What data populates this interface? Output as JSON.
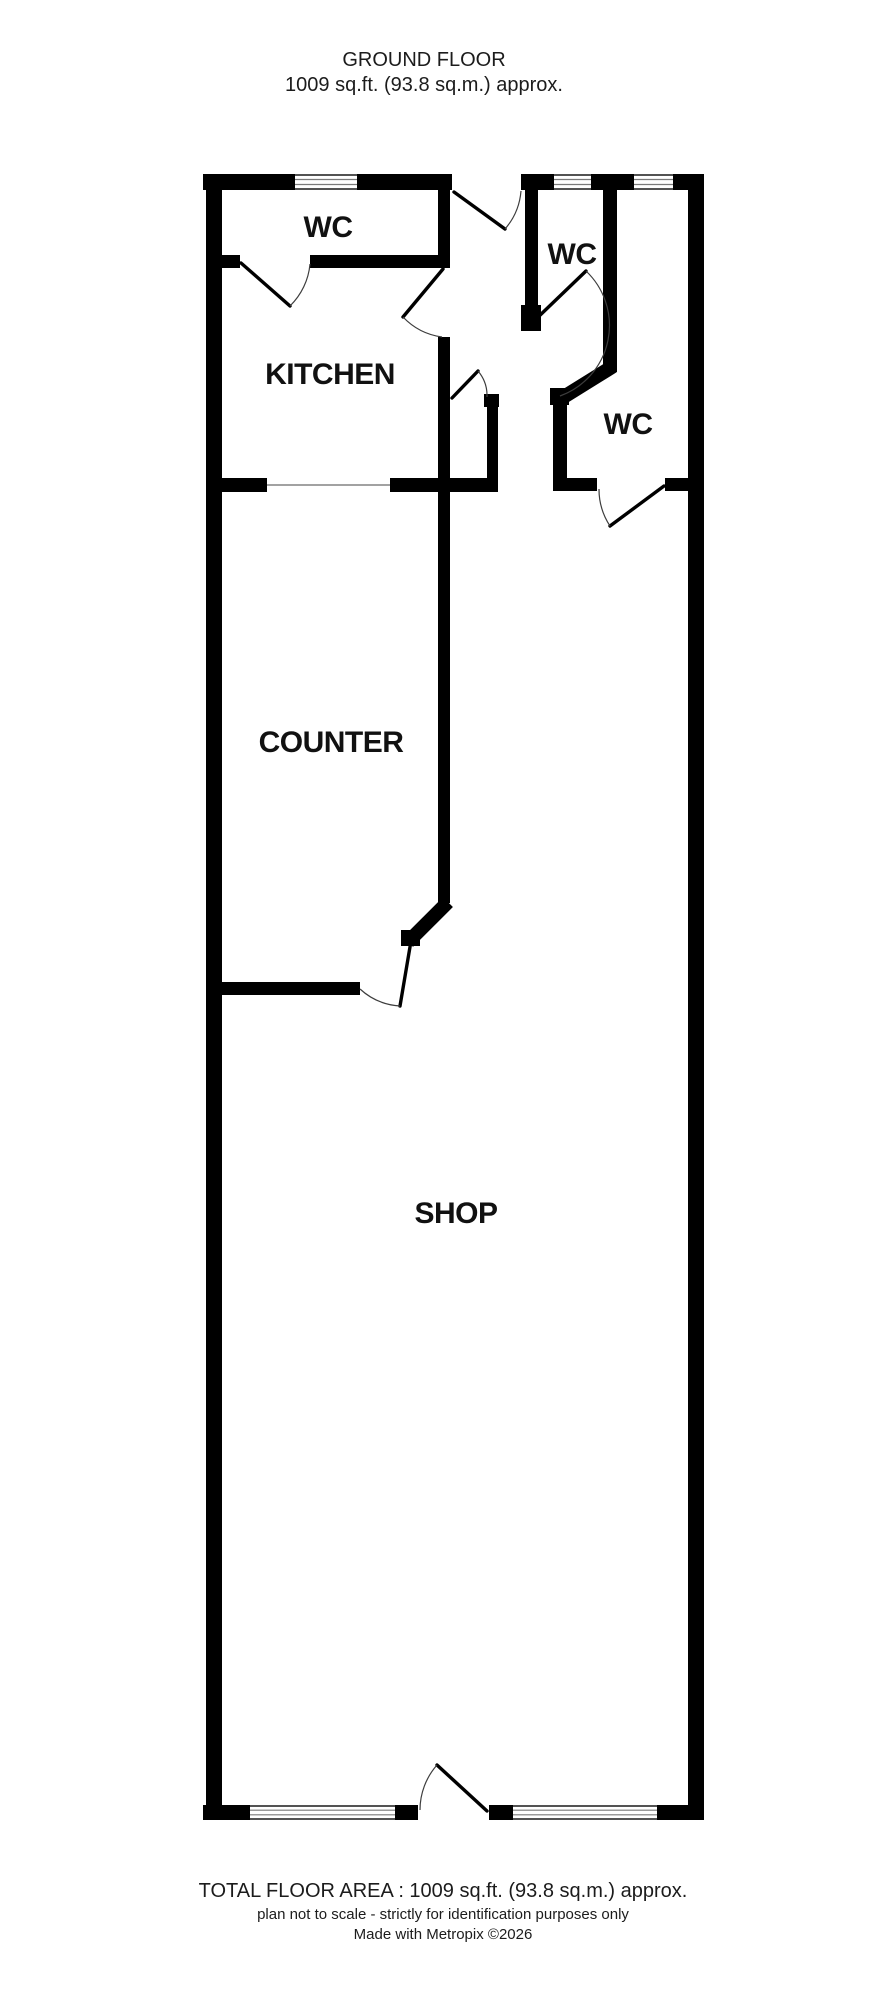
{
  "title": {
    "line1": "GROUND FLOOR",
    "line2": "1009 sq.ft. (93.8 sq.m.) approx."
  },
  "rooms": [
    {
      "id": "wc-top-left",
      "label": "WC"
    },
    {
      "id": "kitchen",
      "label": "KITCHEN"
    },
    {
      "id": "wc-middle",
      "label": "WC"
    },
    {
      "id": "wc-right",
      "label": "WC"
    },
    {
      "id": "counter",
      "label": "COUNTER"
    },
    {
      "id": "shop",
      "label": "SHOP"
    }
  ],
  "footer": {
    "total_area": "TOTAL FLOOR AREA : 1009 sq.ft. (93.8 sq.m.) approx.",
    "disclaimer": "plan not to scale - strictly for identification purposes only",
    "credit": "Made with Metropix ©2026"
  },
  "colors": {
    "wall": "#000000",
    "background": "#ffffff",
    "window_pane_line": "#7a7a7a",
    "door_arc": "#3d3d3d",
    "text": "#1c1c1c"
  }
}
